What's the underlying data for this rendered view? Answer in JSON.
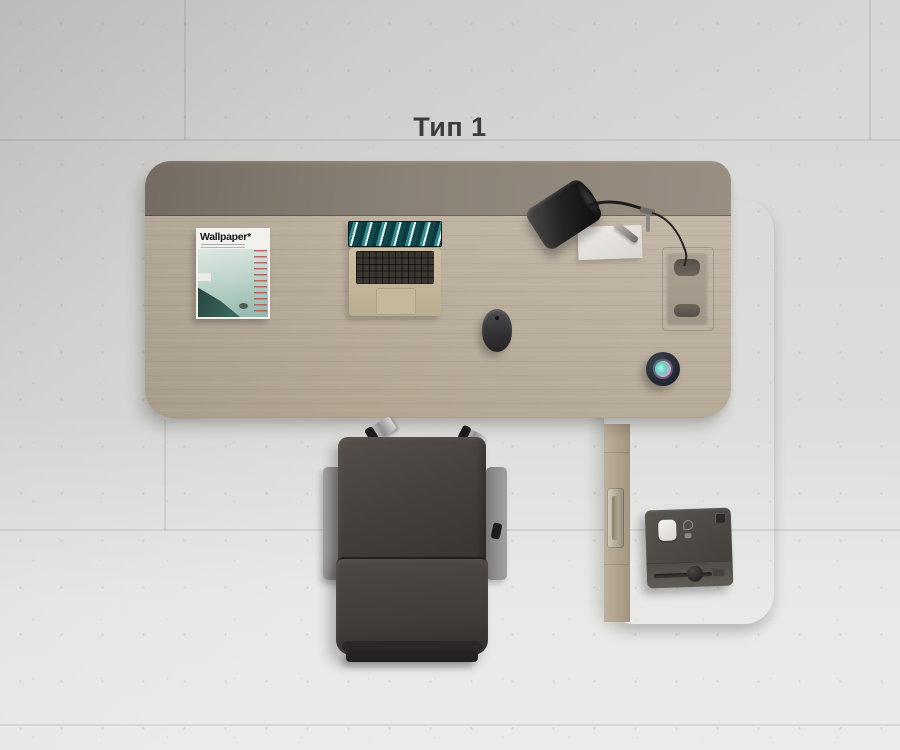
{
  "title": "Тип 1",
  "background": {
    "material": "concrete-tile-floor",
    "base_color": "#d9d9d7"
  },
  "furniture": {
    "desk": {
      "top_color": "#b7ab9a",
      "back_panel_color": "#8a8177",
      "shape": "rounded-rectangle"
    },
    "side_return": {
      "color": "#b0a491",
      "handle_color": "#c5bcab"
    },
    "chair": {
      "upholstery_color": "#45413d",
      "armrest_color": "#908e8c",
      "frame_color": "#d6d6d6"
    }
  },
  "objects": {
    "magazine": {
      "masthead": "Wallpaper*",
      "cover_accent": "#9fc2b5",
      "toc_accent": "#b8463a"
    },
    "laptop": {
      "body_color": "#c5b79a",
      "screen_accent": "#2d8d8d"
    },
    "desk_lamp": {
      "color": "#1c1c1c"
    },
    "notepad": {
      "color": "#e9e7e2"
    },
    "pen": {
      "color": "#8e8b87"
    },
    "mouse": {
      "color": "#3a3a3c"
    },
    "smart_speaker": {
      "body_color": "#262c36",
      "display_colors": [
        "#62d2c4",
        "#dba0c7",
        "#6d63c8"
      ]
    },
    "cable_grommet": {
      "color": "#a79c8e"
    },
    "printer": {
      "body_color": "#4c4946",
      "button_color": "#efedea"
    }
  }
}
